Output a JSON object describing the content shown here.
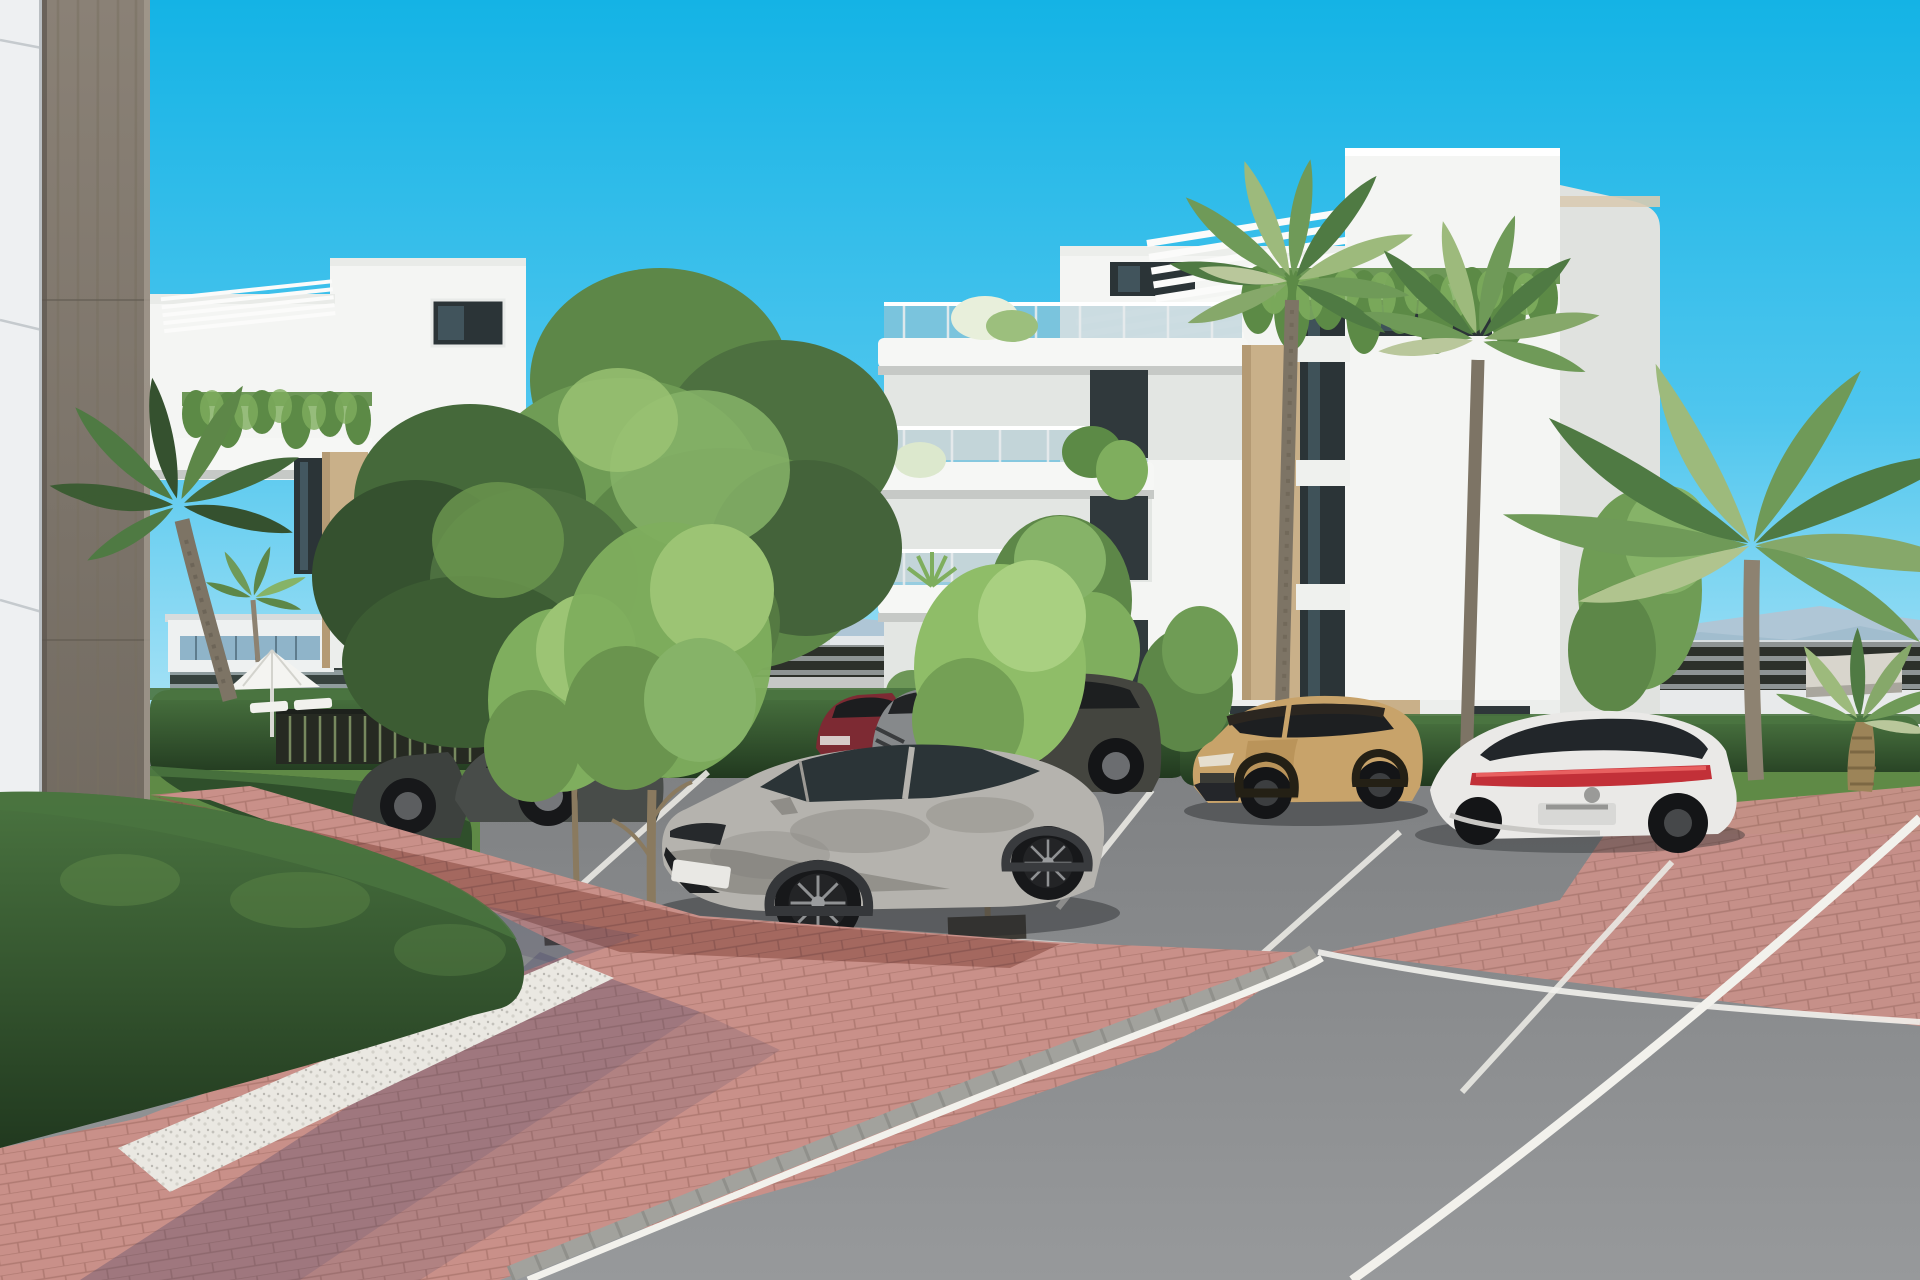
{
  "scene": {
    "title": "architectural-render-apartment-complex-parking",
    "objects": [
      "sky",
      "mountains",
      "distant-city",
      "privacy-fence",
      "boundary-wall",
      "hedges",
      "left-facade-corner",
      "wood-column",
      "left-apartment-building",
      "right-apartment-building",
      "pergolas",
      "hanging-plants",
      "palm-trees",
      "green-trees",
      "parking-lot",
      "road",
      "brick-pavement",
      "gravel-strip",
      "curb",
      "parasol",
      "sun-loungers",
      "pool-fence",
      "concrete-bench",
      "cars"
    ]
  },
  "colors": {
    "sky_top": "#14b3e5",
    "sky_mid": "#4fc6ee",
    "sky_horizon": "#b5e7f7",
    "mountains": "#afc6d6",
    "hills_near": "#9fbbcd",
    "city_white": "#eef1f1",
    "city_shaded": "#d8dee1",
    "city_warm": "#c3a8a0",
    "fence_dark": "#2c302a",
    "fence_gap": "#8e9494",
    "wall_white": "#e8eaeb",
    "road_far": "#aeb2b2",
    "hedge_top": "#4a7440",
    "hedge_mid": "#35562f",
    "hedge_dark": "#21391f",
    "lawn": "#5f8a46",
    "building_white": "#f4f5f3",
    "building_shade": "#e0e2df",
    "parapet_light": "#e9ebe8",
    "slab_shadow": "#c6c9c6",
    "stone_tan": "#c9b089",
    "glass_dark": "#2b3437",
    "glass_reflect": "#53707c",
    "glass_rail": "#aac6d2",
    "panel_white": "#eef0f2",
    "wood_column_hi": "#8a8176",
    "wood_column_lo": "#6d665d",
    "asphalt_far": "#7e8082",
    "asphalt_near": "#97999b",
    "brick_pink": "#c99089",
    "brick_joint": "#b07a72",
    "brick_red": "#95594f",
    "gravel": "#eae8e2",
    "curb": "#a2a29d",
    "line_white": "#f2f1ec",
    "cast_shadow": "#474366",
    "tree_dark": "#35512f",
    "tree_mid": "#5d8748",
    "tree_light": "#86b368",
    "sapling_green": "#8fbd68",
    "palm_dark": "#4f7a43",
    "palm_mid": "#6f9a58",
    "palm_light": "#9dba7c",
    "palm_trunk": "#8d8271",
    "car_silver": "#b5b3ae",
    "car_dark": "#44453f",
    "car_gray": "#86898b",
    "car_red": "#7d2a33",
    "car_tan": "#c8a36a",
    "car_white": "#eae9e7",
    "car_distant": "#c6c8c7",
    "tail_red": "#c23038",
    "umbrella": "#f4f4f1",
    "bench": "#d8d5cc",
    "trunk_brown": "#8a7a5f"
  }
}
